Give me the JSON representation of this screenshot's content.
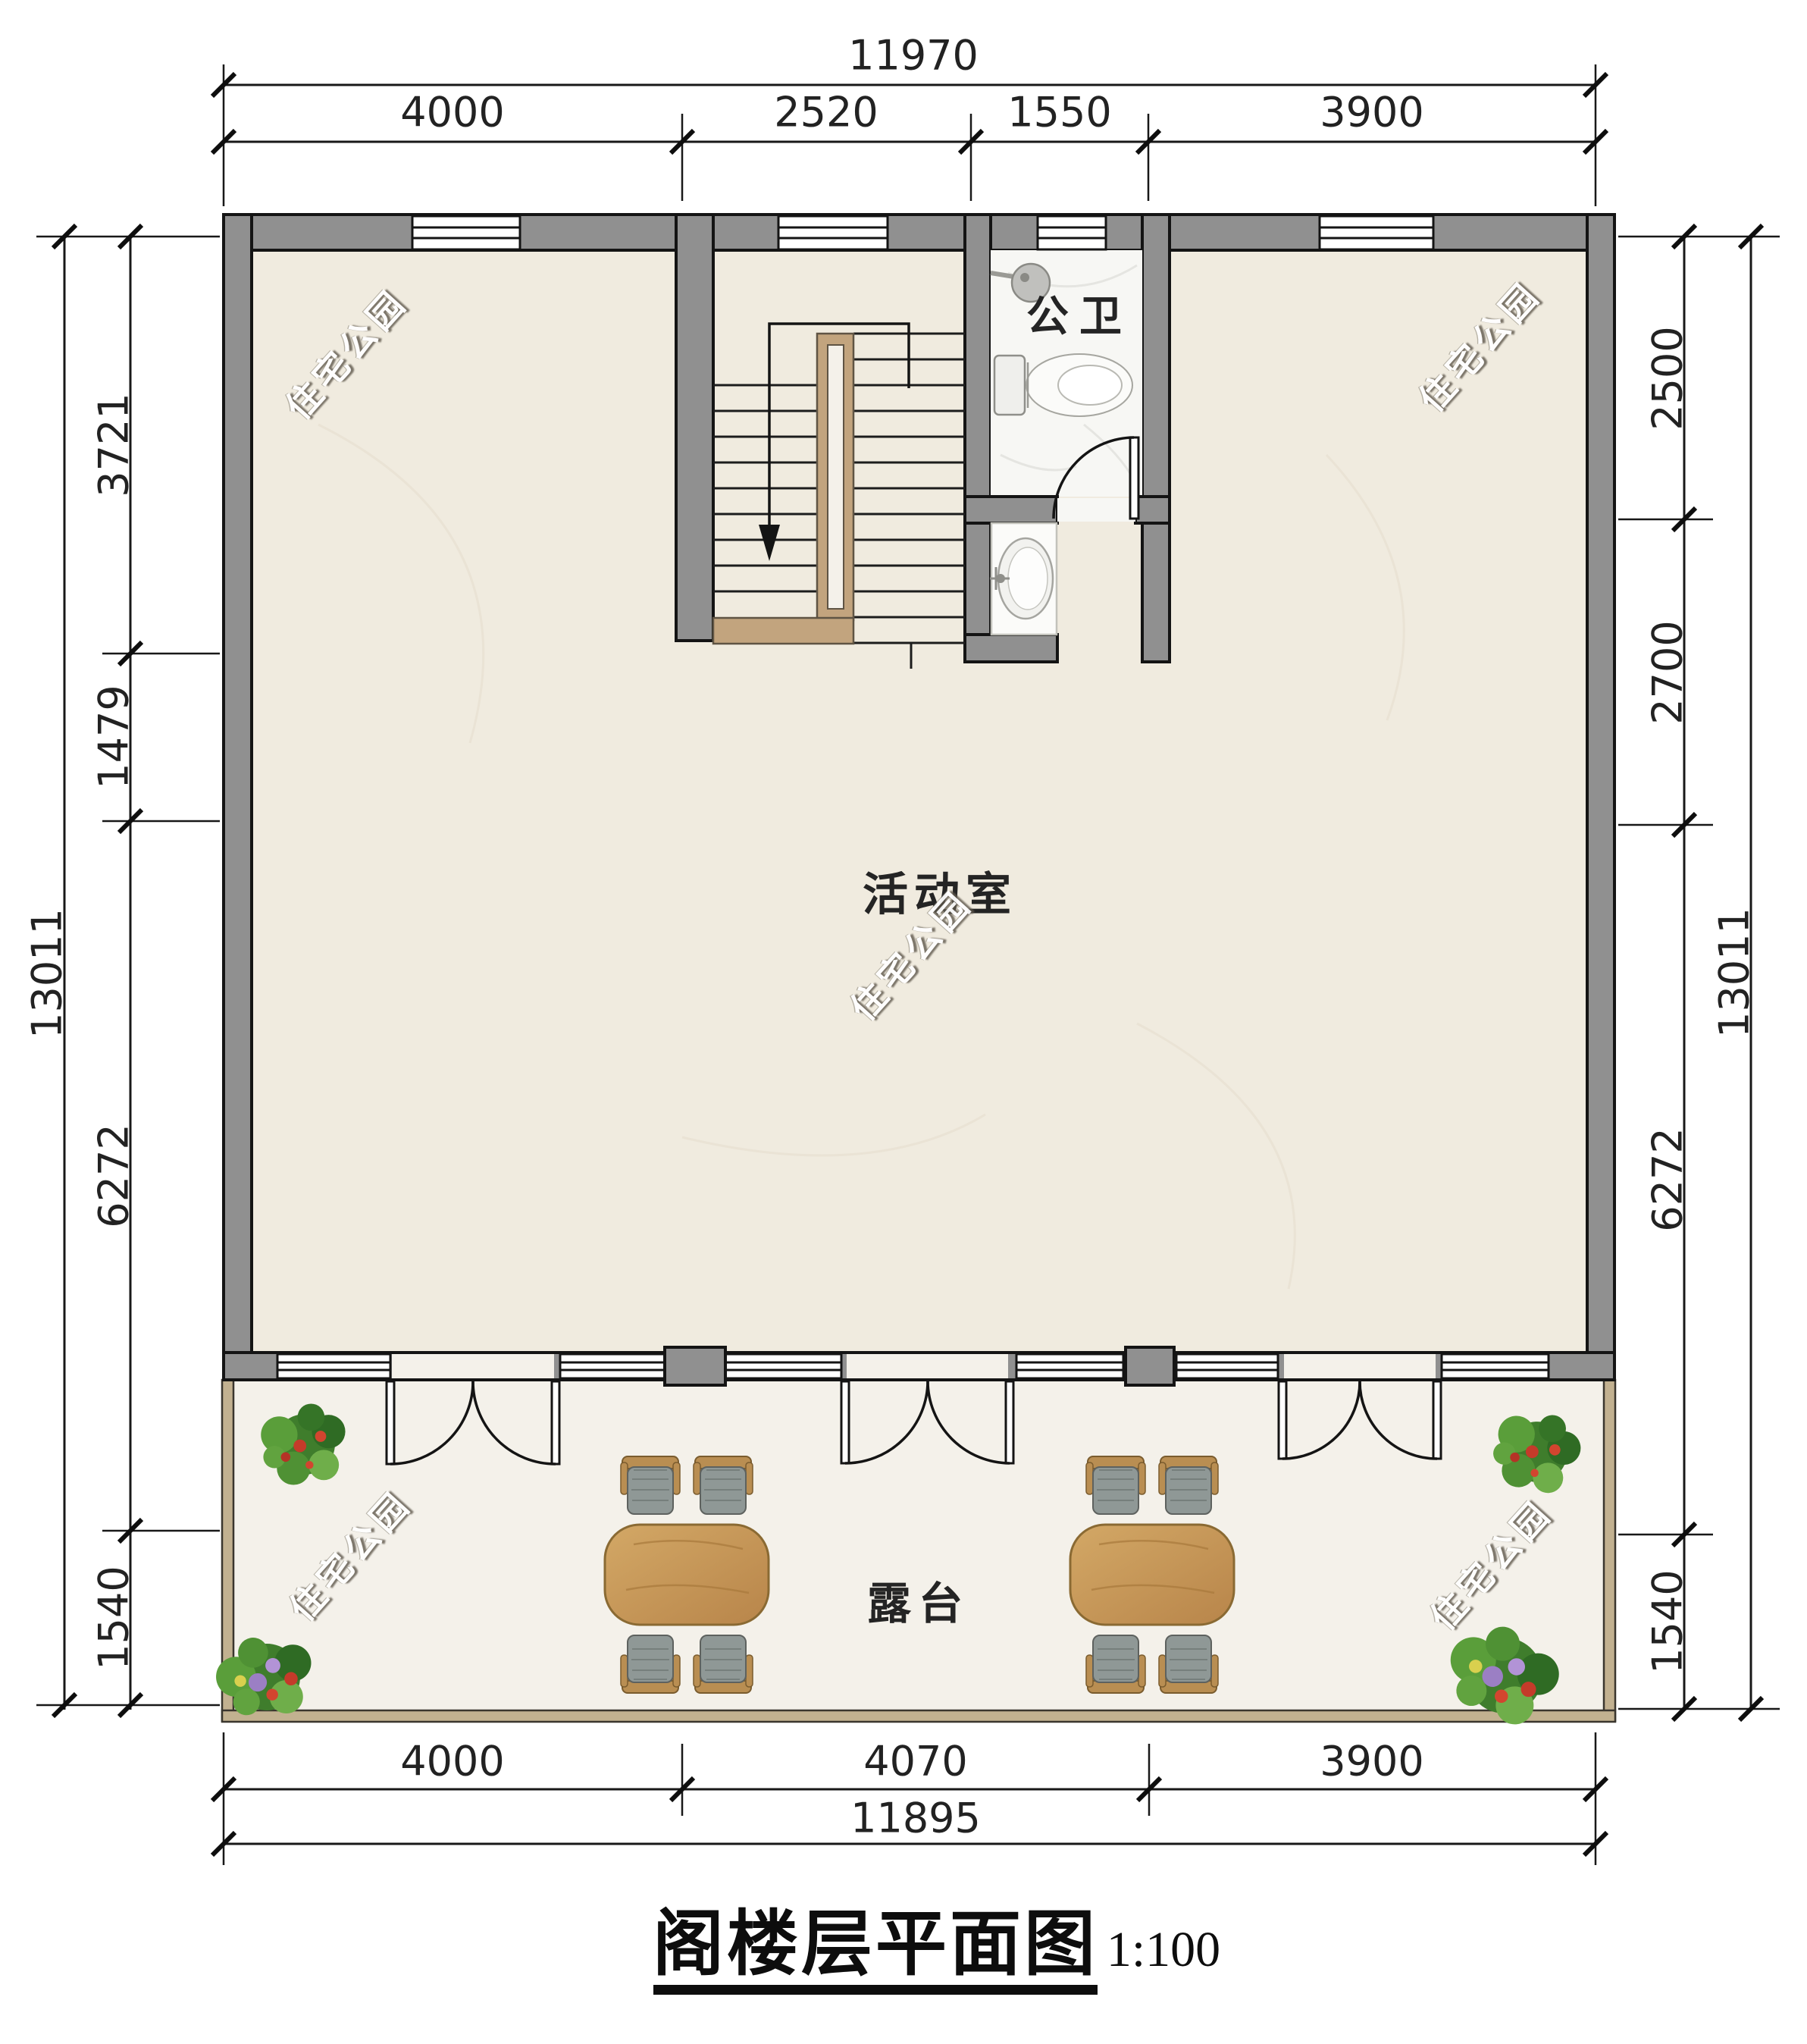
{
  "title": {
    "text": "阁楼层平面图",
    "scale": "1:100"
  },
  "rooms": {
    "activity": "活动室",
    "bathroom": "公卫",
    "terrace": "露台"
  },
  "watermark": {
    "text": "住宅公园"
  },
  "dims": {
    "top": {
      "overall": "11970",
      "segments": [
        "4000",
        "2520",
        "1550",
        "3900"
      ]
    },
    "bottom": {
      "overall": "11895",
      "segments": [
        "4000",
        "4070",
        "3900"
      ]
    },
    "left": {
      "overall": "13011",
      "segments": [
        "3721",
        "1479",
        "6272",
        "1540"
      ]
    },
    "right": {
      "overall": "13011",
      "segments": [
        "2500",
        "2700",
        "6272",
        "1540"
      ]
    }
  },
  "legend": {
    "stair_direction": "down"
  },
  "colors": {
    "wall": "#909090",
    "floor": "#f0ebdf",
    "bath": "#f7f7f4",
    "terrace": "#f4f1ea",
    "parapet": "#c2b190",
    "rail": "#c2a47e",
    "wood": "#c79a58",
    "wooddark": "#9c7437",
    "seat": "#8f9896",
    "plant": "#4a8a33"
  }
}
